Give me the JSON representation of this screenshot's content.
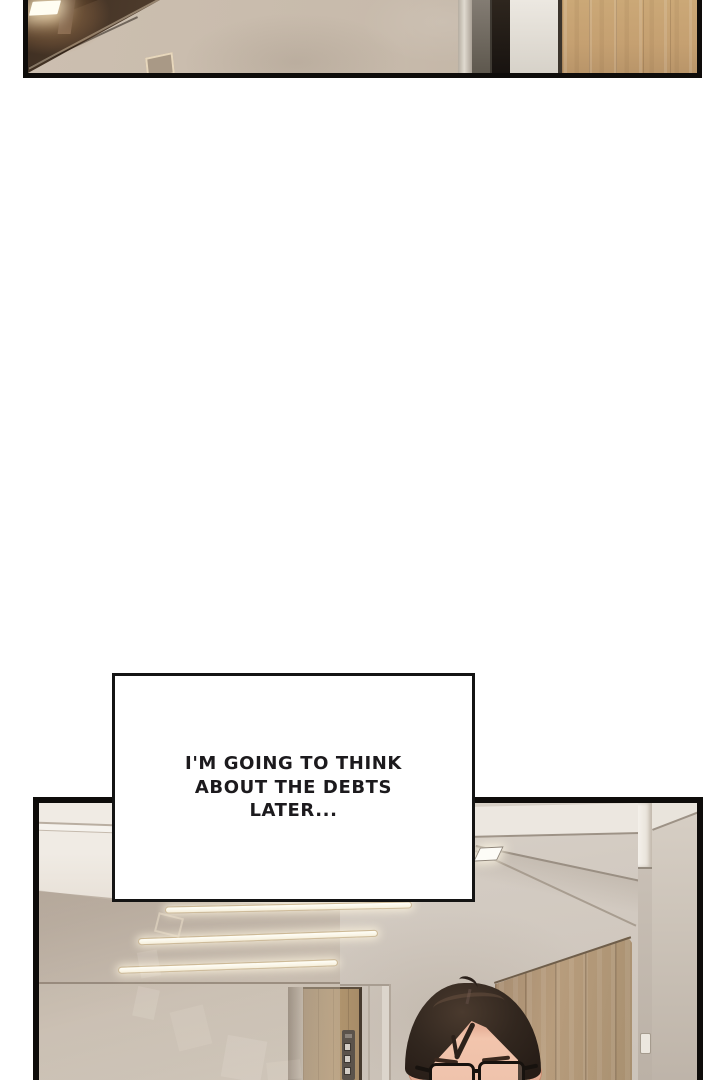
{
  "page": {
    "type": "webtoon-comic-page",
    "background": "#ffffff"
  },
  "speech_bubble": {
    "lines": [
      "I'M GOING TO THINK",
      "ABOUT THE DEBTS",
      "LATER..."
    ],
    "fill": "#ffffff",
    "border": "#141414",
    "text_color": "#1c1a1d"
  },
  "panels": {
    "top": {
      "description": "cropped interior: glowing ceiling light over dark glass wall, plaster wall, door frame, wood panel"
    },
    "bottom": {
      "description": "office hallway: tinted glass partition reflecting ceiling light bars, oak door, wood-panel wall, white pillar, man with glasses at bottom edge"
    }
  },
  "character": {
    "description": "dark-haired man wearing black rectangular glasses, top of head visible",
    "hair_color": "#2f241d",
    "skin_color": "#eec0a9",
    "glasses_color": "#17120e"
  },
  "colors": {
    "ink": "#0e0c0a",
    "paper": "#ffffff",
    "bubble-text": "#1c1a1d",
    "plaster": "#c7baab",
    "wall": "#d4ccc3",
    "ceiling": "#ebe6df",
    "oak": "#ad9271",
    "wood": "#b89c7c",
    "hair": "#2f241d",
    "skin": "#eec0a9",
    "specs": "#17120e",
    "bar": "#fffef7"
  }
}
